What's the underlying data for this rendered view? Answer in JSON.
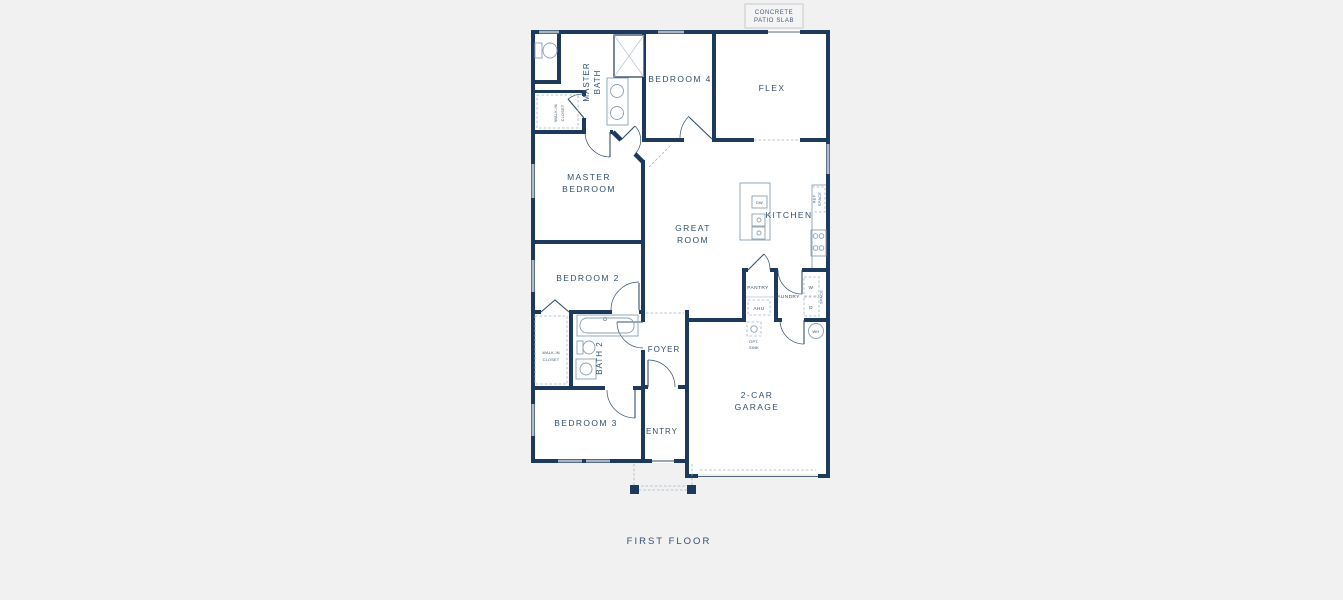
{
  "colors": {
    "background": "#f1f1f2",
    "wall": "#1d3a5c",
    "text": "#33506e",
    "fixture_stroke": "#8aa0b4"
  },
  "plan": {
    "caption": "FIRST FLOOR",
    "labels": {
      "concrete1": "CONCRETE",
      "concrete2": "PATIO SLAB",
      "master_bath1": "MASTER",
      "master_bath2": "BATH",
      "wic1a": "WALK-IN",
      "wic1b": "CLOSET",
      "bedroom4": "BEDROOM 4",
      "flex": "FLEX",
      "master_bed1": "MASTER",
      "master_bed2": "BEDROOM",
      "great1": "GREAT",
      "great2": "ROOM",
      "kitchen": "KITCHEN",
      "dw": "DW",
      "ref1": "REF",
      "ref2": "SPACE",
      "bedroom2": "BEDROOM 2",
      "pantry": "PANTRY",
      "ahu": "AHU",
      "laundry": "LAUNDRY",
      "washer": "W",
      "dryer": "D",
      "wd_note": "SPACE",
      "wh": "WH",
      "opt1": "OPT.",
      "opt2": "SINK",
      "wic2a": "WALK-IN",
      "wic2b": "CLOSET",
      "bath2": "BATH 2",
      "bedroom3": "BEDROOM 3",
      "foyer": "FOYER",
      "entry": "ENTRY",
      "garage1": "2-CAR",
      "garage2": "GARAGE"
    }
  }
}
